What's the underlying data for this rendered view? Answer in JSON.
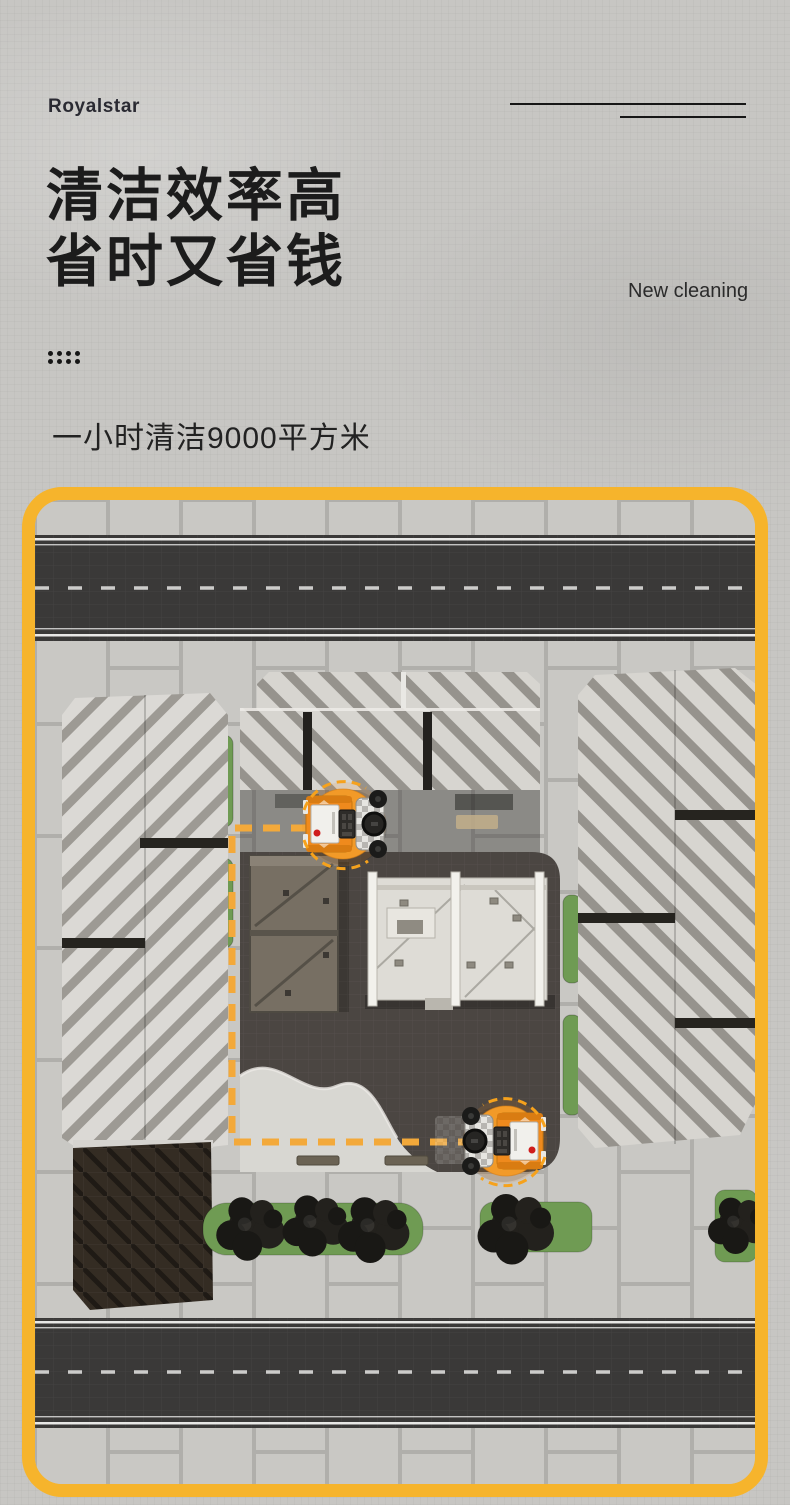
{
  "brand": {
    "logo": "Royalstar"
  },
  "hero": {
    "title_line1": "清洁效率高",
    "title_line2": "省时又省钱",
    "tagline": "New cleaning",
    "subtitle": "一小时清洁9000平方米"
  },
  "scene": {
    "machine_icon": "robot-floor-sweeper",
    "machine_count": 2,
    "route_style": "dashed"
  },
  "colors": {
    "page_bg": "#c7c6c3",
    "text_dark": "#1c1c1c",
    "frame_yellow": "#f6b42c",
    "route_yellow": "#f3a93a",
    "machine_orange": "#ef8a1d",
    "road_dark": "#3a3938",
    "plaza_dark": "#4b4642",
    "paving_light": "#c6c5c1",
    "greenery": "#6f9b53"
  }
}
